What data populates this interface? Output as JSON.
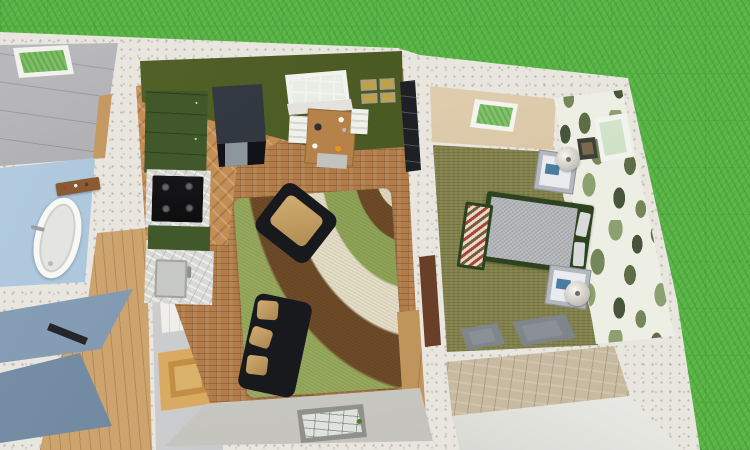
{
  "scene": {
    "type": "3d-floor-plan-render",
    "view": "Top-down aerial 3D rendering of a small house interior surrounded by lawn",
    "visible_text": ""
  },
  "palette": {
    "grass": "#58b345",
    "exterior_wall": "#e9e6e0",
    "roof": "#a6a6a8",
    "accent_wall": "#3f4e1c",
    "cabinet_green": "#40582a",
    "wood_floor": "#c28e55",
    "cork_floor": "#b17c49",
    "bathroom_wall": "#b5cde2",
    "hall_wall": "#6d87a0",
    "bedroom_carpet": "#82814c",
    "bedroom_wall": "#cdb592",
    "bed_frame": "#2d431f",
    "sofa_black": "#17191d",
    "cushion_tan": "#b08c52"
  },
  "rooms": {
    "attic": {
      "label": "Attic roof with skylight"
    },
    "bathroom": {
      "label": "Bathroom"
    },
    "hallway": {
      "label": "Hallway and staircase"
    },
    "living": {
      "label": "Open-plan kitchen, dining and living room"
    },
    "bedroom": {
      "label": "Bedroom"
    },
    "lower_hall": {
      "label": "Lower hallway"
    }
  },
  "objects": {
    "roof_skylight": "Roof skylight",
    "bathtub": "Freestanding oval bathtub",
    "bath_shelf": "Wooden shelf with toiletries",
    "handrail": "Stair handrail",
    "white_door": "White paneled door",
    "oak_door": "Oak door",
    "kitchen_cabinets": "Green kitchen cabinets",
    "stove": "Gas stove with four burners",
    "sink": "Kitchen sink with marble counter",
    "fridge": "Black refrigerator",
    "dining_table": "Wooden dining table",
    "dining_chair": "White dining chair",
    "tableware": "Plates and food on the table",
    "garden_window": "Window overlooking the lawn",
    "picture_frames": "Four picture frames",
    "bookshelf": "Dark shelving unit",
    "rug": "Swirl-pattern shag rug",
    "armchair": "Black armchair with tan cushion",
    "sofa": "Black sofa with tan pillows",
    "console": "Wooden console table",
    "living_window": "South wall window",
    "bedroom_door": "Bedroom door",
    "bedroom_skylight": "Bedroom skylight",
    "bedroom_window": "Bedroom window",
    "leaf_wall": "Tropical leaf wallpaper wall",
    "wall_picture": "Framed picture",
    "bed": "Double bed with grey duvet",
    "foot_bench": "Patterned bench at foot of bed",
    "nightstand": "Nightstand with lamp",
    "lamp": "Table lamp",
    "closet_doors": "Grey paneled closet doors"
  }
}
